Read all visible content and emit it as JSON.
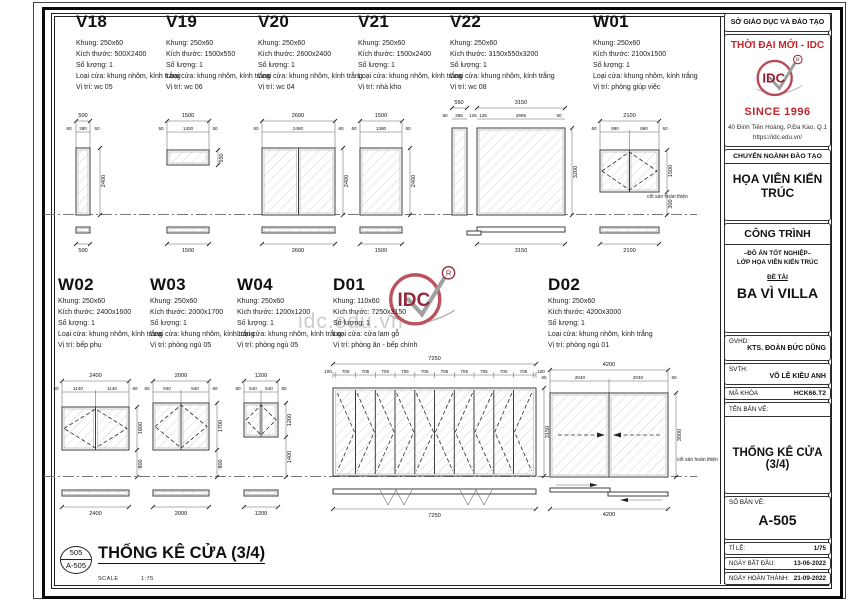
{
  "sheet": {
    "spec_labels": {
      "khung": "Khung:",
      "kich_thuoc": "Kích thước:",
      "so_luong": "Số lượng:",
      "loai_cua": "Loại cửa:",
      "vi_tri": "Vị trí:"
    },
    "floor_label": "cốt sàn hoàn thiện",
    "watermark": "idc.edu.vn"
  },
  "logo": {
    "text": "IDC",
    "reg": "R"
  },
  "units": [
    {
      "title": "V18",
      "specs": {
        "khung": "250x60",
        "kich_thuoc": "500X2400",
        "so_luong": "1",
        "loai_cua": "khung nhôm, kính trắng",
        "vi_tri": "wc 05"
      },
      "dims": {
        "overall": "500",
        "segments": [
          "60",
          "380",
          "60"
        ],
        "height": "2400",
        "plan": "500"
      }
    },
    {
      "title": "V19",
      "specs": {
        "khung": "250x60",
        "kich_thuoc": "1500x550",
        "so_luong": "1",
        "loai_cua": "khung nhôm, kính trắng",
        "vi_tri": "wc 06"
      },
      "dims": {
        "overall": "1500",
        "segments": [
          "50",
          "1400",
          "50"
        ],
        "height": "550",
        "plan": "1500"
      }
    },
    {
      "title": "V20",
      "specs": {
        "khung": "250x60",
        "kich_thuoc": "2600x2400",
        "so_luong": "1",
        "loai_cua": "khung nhôm, kính trắng",
        "vi_tri": "wc 04"
      },
      "dims": {
        "overall": "2600",
        "segments": [
          "60",
          "2480",
          "60"
        ],
        "height": "2400",
        "plan": "2600"
      }
    },
    {
      "title": "V21",
      "specs": {
        "khung": "250x60",
        "kich_thuoc": "1500x2400",
        "so_luong": "1",
        "loai_cua": "khung nhôm, kính trắng",
        "vi_tri": "nhà kho"
      },
      "dims": {
        "overall": "1500",
        "segments": [
          "60",
          "1380",
          "60"
        ],
        "height": "2400",
        "plan": "1500"
      }
    },
    {
      "title": "V22",
      "specs": {
        "khung": "250x60",
        "kich_thuoc": "3150x550x3200",
        "so_luong": "1",
        "loai_cua": "khung nhôm, kính trắng",
        "vi_tri": "wc 08"
      },
      "dims": {
        "overall": "3150",
        "overall2": "550",
        "segments": [
          "125",
          "2965",
          "60"
        ],
        "segments2": [
          "60",
          "365",
          "125"
        ],
        "height": "3200",
        "plan": "3150"
      }
    },
    {
      "title": "W01",
      "specs": {
        "khung": "250x60",
        "kich_thuoc": "2100x1500",
        "so_luong": "1",
        "loai_cua": "khung nhôm, kính trắng",
        "vi_tri": "phòng giúp việc"
      },
      "dims": {
        "overall": "2100",
        "segments": [
          "60",
          "990",
          "990",
          "60"
        ],
        "height": "1500",
        "below": "300",
        "plan": "2100"
      }
    },
    {
      "title": "W02",
      "specs": {
        "khung": "250x60",
        "kich_thuoc": "2400x1600",
        "so_luong": "1",
        "loai_cua": "khung nhôm, kính trắng",
        "vi_tri": "bếp phụ"
      },
      "dims": {
        "overall": "2400",
        "segments": [
          "60",
          "1140",
          "1140",
          "60"
        ],
        "height": "1600",
        "below": "800",
        "plan": "2400"
      }
    },
    {
      "title": "W03",
      "specs": {
        "khung": "250x60",
        "kich_thuoc": "2000x1700",
        "so_luong": "1",
        "loai_cua": "khung nhôm, kính trắng",
        "vi_tri": "phòng ngủ 05"
      },
      "dims": {
        "overall": "2000",
        "segments": [
          "60",
          "940",
          "940",
          "60"
        ],
        "height": "1700",
        "below": "800",
        "plan": "2000"
      }
    },
    {
      "title": "W04",
      "specs": {
        "khung": "250x60",
        "kich_thuoc": "1200x1200",
        "so_luong": "1",
        "loai_cua": "khung nhôm, kính trắng",
        "vi_tri": "phòng ngủ 05"
      },
      "dims": {
        "overall": "1200",
        "segments": [
          "60",
          "540",
          "540",
          "60"
        ],
        "height": "1200",
        "below": "1400",
        "plan": "1200"
      }
    },
    {
      "title": "D01",
      "specs": {
        "khung": "110x60",
        "kich_thuoc": "7250x3150",
        "so_luong": "1",
        "loai_cua": "cửa lam gỗ",
        "vi_tri": "phòng ăn - bếp chính"
      },
      "dims": {
        "overall": "7250",
        "segments": [
          "100",
          "705",
          "705",
          "705",
          "705",
          "705",
          "705",
          "705",
          "705",
          "705",
          "705",
          "100"
        ],
        "height": "3150",
        "plan": "7250"
      }
    },
    {
      "title": "D02",
      "specs": {
        "khung": "250x60",
        "kich_thuoc": "4200x3000",
        "so_luong": "1",
        "loai_cua": "khung nhôm, kính trắng",
        "vi_tri": "phòng ngủ 01"
      },
      "dims": {
        "overall": "4200",
        "segments": [
          "60",
          "2040",
          "2040",
          "60"
        ],
        "height": "3000",
        "plan": "4200"
      }
    }
  ],
  "title_block": {
    "dept": "SỞ GIÁO DỤC VÀ ĐÀO TẠO",
    "brand": "THỜI ĐẠI MỚI - IDC",
    "since": "SINCE 1996",
    "address": "40 Đinh Tiên Hoàng, P.Đa Kao, Q.1",
    "website": "https://idc.edu.vn/",
    "training_header": "CHUYÊN NGÀNH ĐÀO TẠO",
    "training_name": "HỌA VIÊN KIẾN TRÚC",
    "project_header": "CÔNG TRÌNH",
    "project_line1": "–ĐỒ ÁN TỐT NGHIỆP–",
    "project_line2": "LỚP HỌA VIÊN KIẾN TRÚC",
    "topic_label": "ĐỀ TÀI",
    "topic_name": "BA VÌ VILLA",
    "gvhd_label": "GVHD:",
    "gvhd_name": "KTS. ĐOÀN ĐỨC DŨNG",
    "svth_label": "SVTH:",
    "svth_name": "VÕ LÊ KIỀU ANH",
    "code_label": "MÃ KHÓA",
    "code_value": "HCK66.T2",
    "drawing_name_label": "TÊN BẢN VẼ:",
    "drawing_name": "THỐNG KÊ CỬA (3/4)",
    "sheet_no_label": "SỐ BẢN VẼ:",
    "sheet_no": "A-505",
    "scale_label": "TỈ LỆ:",
    "scale_value": "1/75",
    "start_label": "NGÀY BẮT ĐẦU:",
    "start_date": "13-06-2022",
    "end_label": "NGÀY HOÀN THÀNH:",
    "end_date": "21-09-2022"
  },
  "footer": {
    "bubble_top": "505",
    "bubble_bottom": "A-505",
    "title": "THỐNG KÊ CỬA (3/4)",
    "scale_label": "SCALE",
    "scale_value": "1:75"
  }
}
